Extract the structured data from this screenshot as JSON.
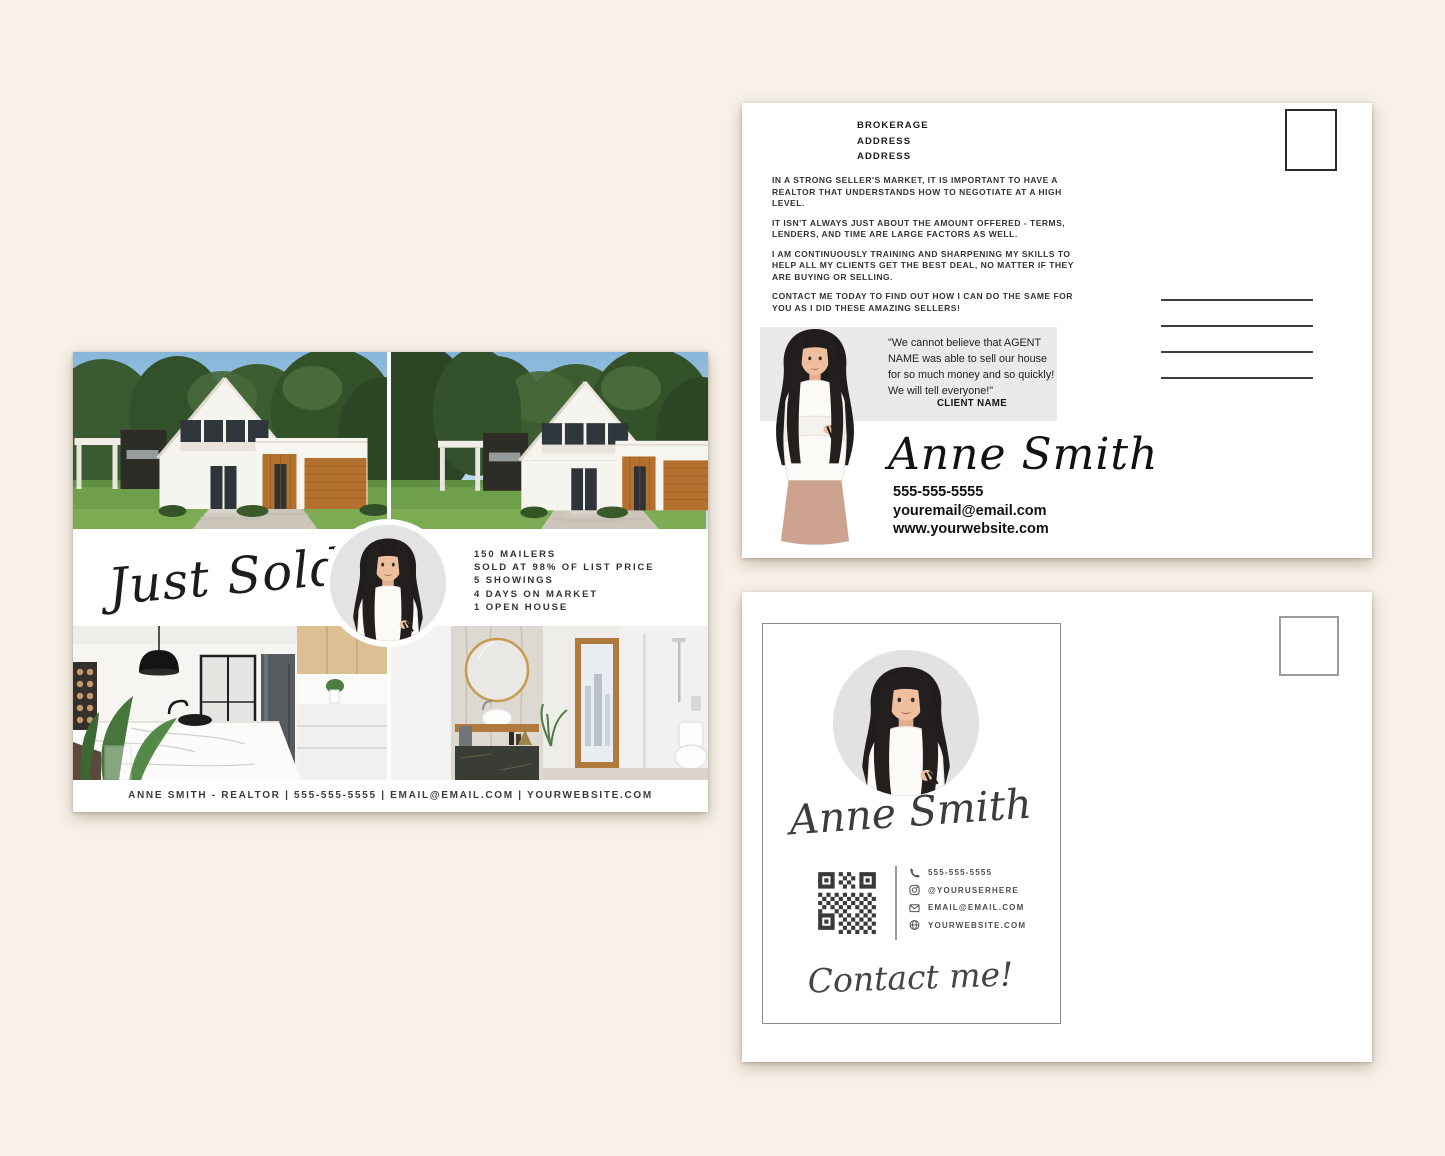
{
  "colors": {
    "page_background": "#f7f1e8",
    "card_background": "#ffffff",
    "wood_accent": "#b4702e",
    "quote_box": "#eaeaea"
  },
  "front": {
    "headline": "Just Sold",
    "stats": [
      "150 MAILERS",
      "SOLD AT 98% OF LIST PRICE",
      "5 SHOWINGS",
      "4 DAYS ON MARKET",
      "1 OPEN HOUSE"
    ],
    "footer": "ANNE SMITH - REALTOR | 555-555-5555 | EMAIL@EMAIL.COM | YOURWEBSITE.COM"
  },
  "back": {
    "brokerage": [
      "BROKERAGE",
      "ADDRESS",
      "ADDRESS"
    ],
    "paragraphs": [
      "IN A STRONG SELLER'S MARKET, IT IS IMPORTANT TO HAVE A REALTOR THAT UNDERSTANDS HOW TO NEGOTIATE AT A HIGH LEVEL.",
      "IT ISN'T ALWAYS JUST ABOUT THE AMOUNT OFFERED - TERMS, LENDERS, AND TIME ARE LARGE FACTORS AS WELL.",
      "I AM CONTINUOUSLY TRAINING AND SHARPENING MY SKILLS TO HELP ALL MY CLIENTS GET THE BEST DEAL, NO MATTER IF THEY ARE BUYING OR SELLING.",
      "CONTACT ME TODAY TO FIND OUT HOW I CAN DO THE SAME FOR YOU AS I DID THESE AMAZING SELLERS!"
    ],
    "testimonial_quote": "\"We cannot believe that AGENT NAME was able to sell our house for so much money and so quickly! We will tell everyone!\"",
    "testimonial_client": "CLIENT NAME",
    "agent_name": "Anne Smith",
    "phone": "555-555-5555",
    "email": "youremail@email.com",
    "website": "www.yourwebsite.com"
  },
  "contact_card": {
    "agent_name": "Anne Smith",
    "phone": "555-555-5555",
    "instagram": "@YOURUSERHERE",
    "email": "EMAIL@EMAIL.COM",
    "website": "YOURWEBSITE.COM",
    "cta": "Contact me!"
  }
}
